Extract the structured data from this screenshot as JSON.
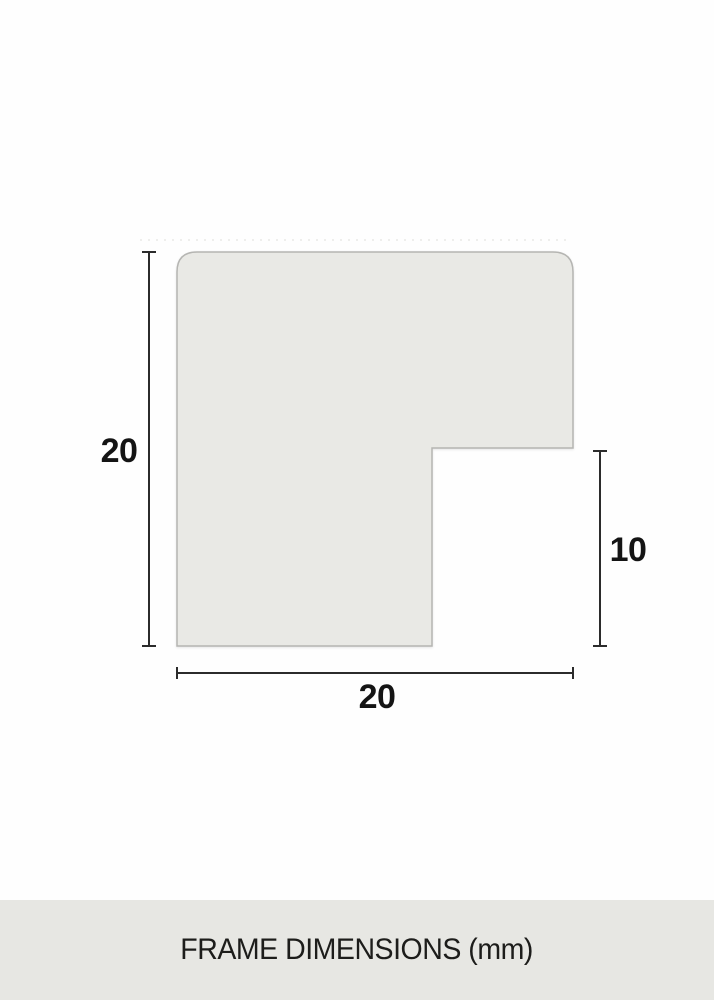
{
  "diagram": {
    "title": "frame moulding profile cross-section",
    "dimensions": {
      "height_mm": "20",
      "width_mm": "20",
      "rabbet_depth_mm": "10"
    },
    "caption": "FRAME DIMENSIONS (mm)",
    "unit": "mm"
  },
  "colors": {
    "background": "#fefefe",
    "shape_fill": "#e9e9e5",
    "shape_border": "#b5b5b2",
    "dimension_line": "#2b2b2b",
    "label_text": "#141414",
    "footer_bg": "#e7e7e3",
    "footer_text": "#1d1d1b"
  }
}
